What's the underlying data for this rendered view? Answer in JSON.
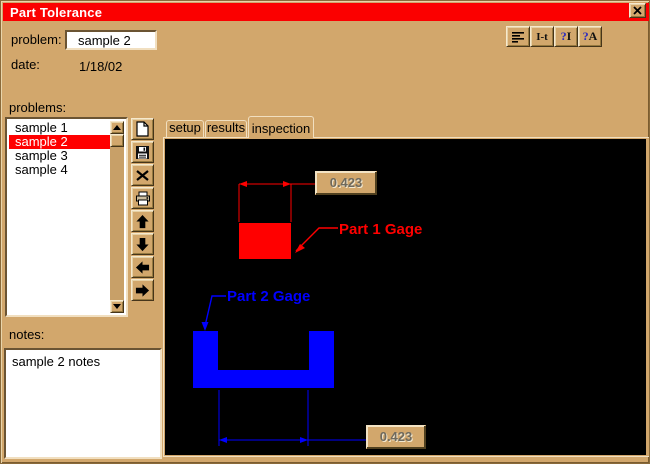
{
  "window": {
    "title": "Part Tolerance"
  },
  "header": {
    "problem_label": "problem:",
    "problem_value": "sample 2",
    "date_label": "date:",
    "date_value": "1/18/02"
  },
  "top_toolbar": {
    "it_label": "I-t",
    "help_q": "?",
    "help_i_letter": "I",
    "help_a_letter": "A"
  },
  "problems": {
    "label": "problems:",
    "items": [
      {
        "label": "sample 1",
        "selected": false
      },
      {
        "label": "sample 2",
        "selected": true
      },
      {
        "label": "sample 3",
        "selected": false
      },
      {
        "label": "sample 4",
        "selected": false
      }
    ]
  },
  "notes": {
    "label": "notes:",
    "value": "sample 2 notes"
  },
  "tabs": [
    {
      "label": "setup",
      "active": false
    },
    {
      "label": "results",
      "active": false
    },
    {
      "label": "inspection",
      "active": true
    }
  ],
  "inspection": {
    "part1_label": "Part 1 Gage",
    "part2_label": "Part 2 Gage",
    "dim_top": "0.423",
    "dim_bottom": "0.423",
    "part1_color": "#ff0000",
    "part2_color": "#0000ff",
    "canvas_color": "#000000"
  },
  "colors": {
    "titlebar": "#fb0000",
    "background": "#d2a76c",
    "selection": "#ff0000"
  }
}
